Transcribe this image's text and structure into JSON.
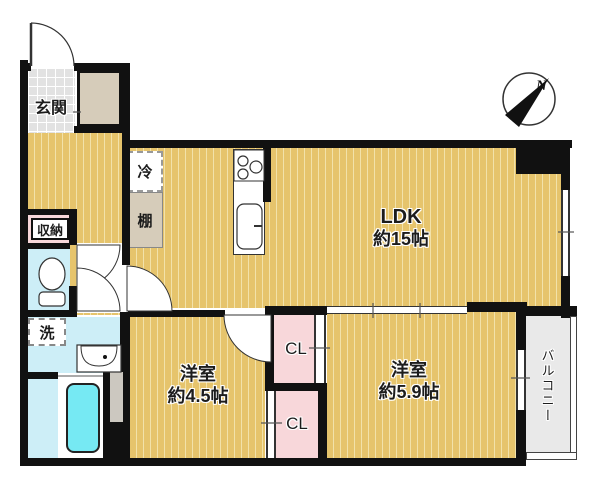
{
  "floorplan": {
    "labels": {
      "entrance": "玄関",
      "storage": "収納",
      "laundry": "洗",
      "fridge": "冷",
      "shelf": "棚",
      "ldk": {
        "name": "LDK",
        "area": "約15帖"
      },
      "bedroom_small": {
        "name": "洋室",
        "area": "約4.5帖"
      },
      "bedroom_large": {
        "name": "洋室",
        "area": "約5.9帖"
      },
      "closet_upper": "CL",
      "closet_lower": "CL",
      "balcony": "バルコニー",
      "compass_north": "N"
    },
    "colors": {
      "wall": "#111111",
      "floor_wood": "#e6c46c",
      "floor_stripe": "#f2e2aa",
      "wet_area": "#cdeef7",
      "bathtub": "#76e9f3",
      "closet_pink": "#f8d7da",
      "cabinet_beige": "#d6ccba",
      "balcony_grey": "#e9e9e9",
      "entrance_tile": "#e2e2e2"
    }
  }
}
